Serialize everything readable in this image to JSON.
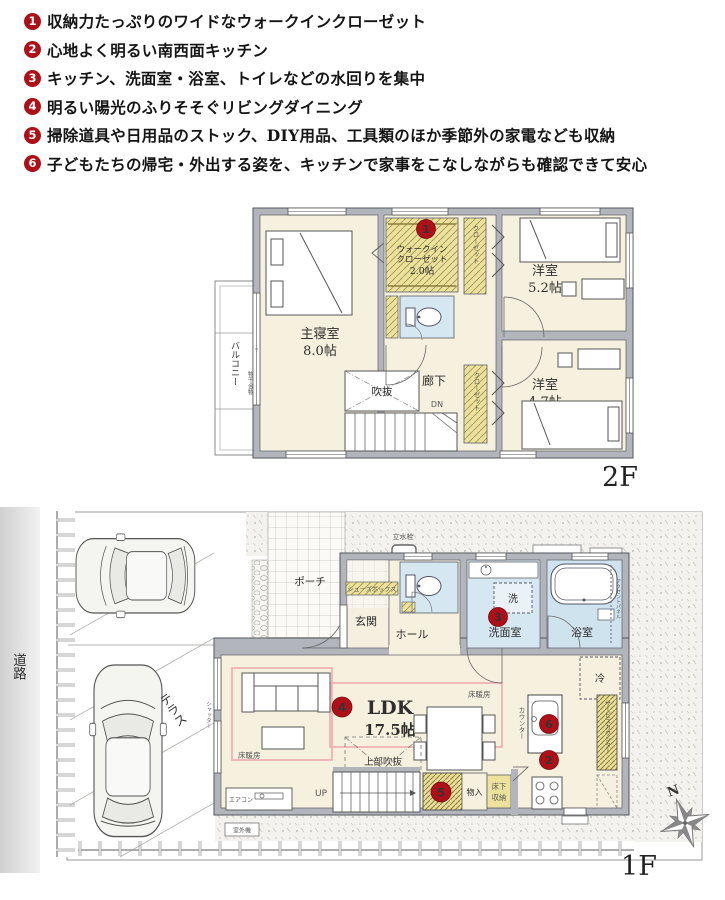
{
  "features": [
    {
      "num": "1",
      "text": "収納力たっぷりのワイドなウォークインクローゼット"
    },
    {
      "num": "2",
      "text": "心地よく明るい南西面キッチン"
    },
    {
      "num": "3",
      "text": "キッチン、洗面室・浴室、トイレなどの水回りを集中"
    },
    {
      "num": "4",
      "text": "明るい陽光のふりそそぐリビングダイニング"
    },
    {
      "num": "5",
      "text": "掃除道具や日用品のストック、DIY用品、工具類のほか季節外の家電なども収納"
    },
    {
      "num": "6",
      "text": "子どもたちの帰宅・外出する姿を、キッチンで家事をこなしながらも確認できて安心"
    }
  ],
  "floor2": {
    "floor_label": "2F",
    "balcony": "バルコニー",
    "hanger": "物干金物",
    "master": "主寝室",
    "master_size": "8.0帖",
    "wic_line1": "ウォークイン",
    "wic_line2": "クローゼット",
    "wic_size": "2.0帖",
    "closet_top": "クローゼット",
    "closet_bottom": "クローゼット",
    "west_top": "洋室",
    "west_top_size": "5.2帖",
    "west_bottom": "洋室",
    "west_bottom_size": "4.7帖",
    "hall": "廊下",
    "void": "吹抜",
    "down": "DN"
  },
  "floor1": {
    "floor_label": "1F",
    "road": "道路",
    "terrace": "テラス",
    "shutter": "シャッター",
    "porch": "ポーチ",
    "shoebox": "シューズボックス",
    "entrance": "玄関",
    "hall": "ホール",
    "washer": "洗",
    "washroom": "洗面室",
    "bath": "浴室",
    "accent_panel": "アクセントパネル",
    "fridge": "冷",
    "ldk": "LDK",
    "ldk_size": "17.5帖",
    "floor_heat_left": "床暖房",
    "floor_heat_right": "床暖房",
    "upper_void": "上部吹抜",
    "up": "UP",
    "closet": "物入",
    "underfloor_line1": "床下",
    "underfloor_line2": "収納",
    "counter": "カウンター",
    "service_counter": "サービスカウンター",
    "tap": "立水栓",
    "aircon": "エアコン",
    "outdoor_unit": "室外機",
    "north": "N"
  },
  "markers": {
    "m1": "1",
    "m2": "2",
    "m3": "3",
    "m4": "4",
    "m5": "5",
    "m6": "6"
  },
  "colors": {
    "accent_red": "#ad1018",
    "wall_gray": "#b2b5bc",
    "room_cream": "#f6f1de",
    "closet_yellow": "#ece29e",
    "wet_blue": "#d5e7f1",
    "heat_pink": "#eeaab0"
  }
}
